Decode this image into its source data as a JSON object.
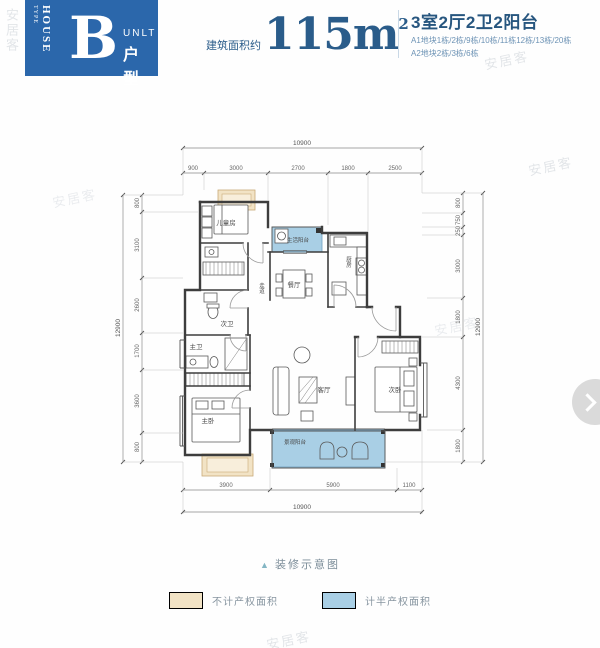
{
  "watermark_text": "安居客",
  "header": {
    "badge": {
      "vertical_small": "TYPE",
      "vertical_large": "HOUSE",
      "letter": "B",
      "unit_en": "UNLT",
      "unit_cn": "户型"
    },
    "area": {
      "prefix": "建筑面积约",
      "value": "115m",
      "superscript": "2"
    },
    "summary": {
      "title": "3室2厅2卫2阳台",
      "line1": "A1地块1栋/2栋/9栋/10栋/11栋12栋/13栋/20栋",
      "line2": "A2地块2栋/3栋/6栋"
    }
  },
  "plan": {
    "room_labels": {
      "children_room": "儿童房",
      "life_balcony": "生活阳台",
      "kitchen": "厨房",
      "dining_room": "餐厅",
      "corridor": "走道",
      "second_bathroom": "次卫",
      "master_bathroom": "主卫",
      "master_bedroom": "主卧",
      "living_room": "客厅",
      "second_bedroom": "次卧",
      "view_balcony": "景观阳台"
    },
    "dimensions": {
      "top_total": "10900",
      "top_segments": [
        "900",
        "3000",
        "2700",
        "1800",
        "2500"
      ],
      "left_total": "12900",
      "left_segments": [
        "800",
        "3100",
        "2600",
        "1700",
        "3600",
        "800"
      ],
      "right_total": "12900",
      "right_segments": [
        "800",
        "750",
        "250",
        "3000",
        "1800",
        "4300",
        "1800"
      ],
      "bottom_total": "10900",
      "bottom_segments": [
        "3900",
        "5900",
        "1100"
      ]
    }
  },
  "footer": {
    "caption": "装修示意图",
    "legend": [
      {
        "label": "不计产权面积",
        "color": "#f2e3c5"
      },
      {
        "label": "计半产权面积",
        "color": "#a9cfe5"
      }
    ]
  },
  "colors": {
    "header_blue": "#2b67ab",
    "title_blue": "#2a5c8a",
    "balcony_blue": "#a9cfe5",
    "planter_tan": "#f2e3c5"
  }
}
